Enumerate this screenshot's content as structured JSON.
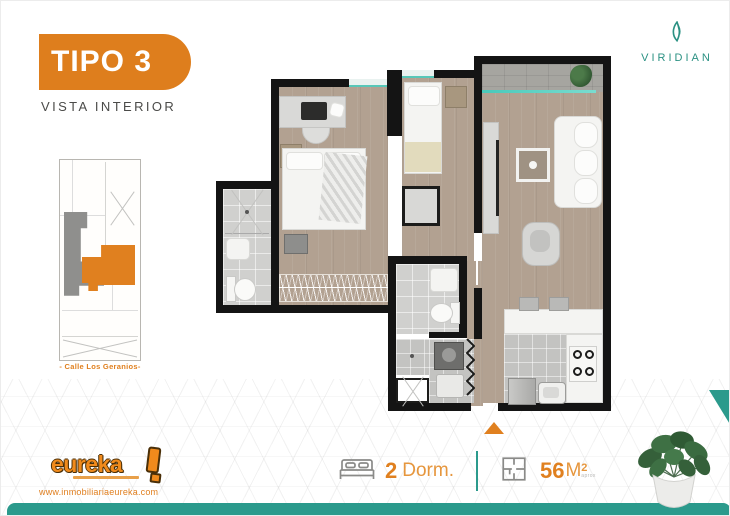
{
  "header": {
    "tipo_label": "TIPO 3",
    "subtitle": "VISTA INTERIOR"
  },
  "brand": {
    "name": "VIRIDIAN",
    "color": "#2B9183"
  },
  "siteplan": {
    "street_label": "- Calle Los Geranios-",
    "highlight_unit_color": "#E0801F",
    "other_unit_color": "#8F8F8D"
  },
  "footer": {
    "logo_text": "eureka",
    "website": "www.inmobiliariaeureka.com",
    "specs": {
      "bedrooms_value": "2",
      "bedrooms_label": "Dorm.",
      "area_value": "56",
      "area_unit": "M",
      "area_sup": "2",
      "area_note": "aprox"
    }
  },
  "colors": {
    "accent_orange": "#E0801F",
    "teal": "#2B9A8C",
    "glass_teal": "#49C9BA",
    "wall_black": "#141414",
    "wood_floor": "#B2A191"
  },
  "icons": {
    "leaf-icon": "viridian leaf mark (teal curved strokes)",
    "bed-icon": "double bed outline glyph",
    "floorplan-icon": "floor plan square outline glyph",
    "entry-arrow-icon": "orange upward triangle (unit entrance)",
    "plant-photo": "potted green plant in white pot"
  }
}
